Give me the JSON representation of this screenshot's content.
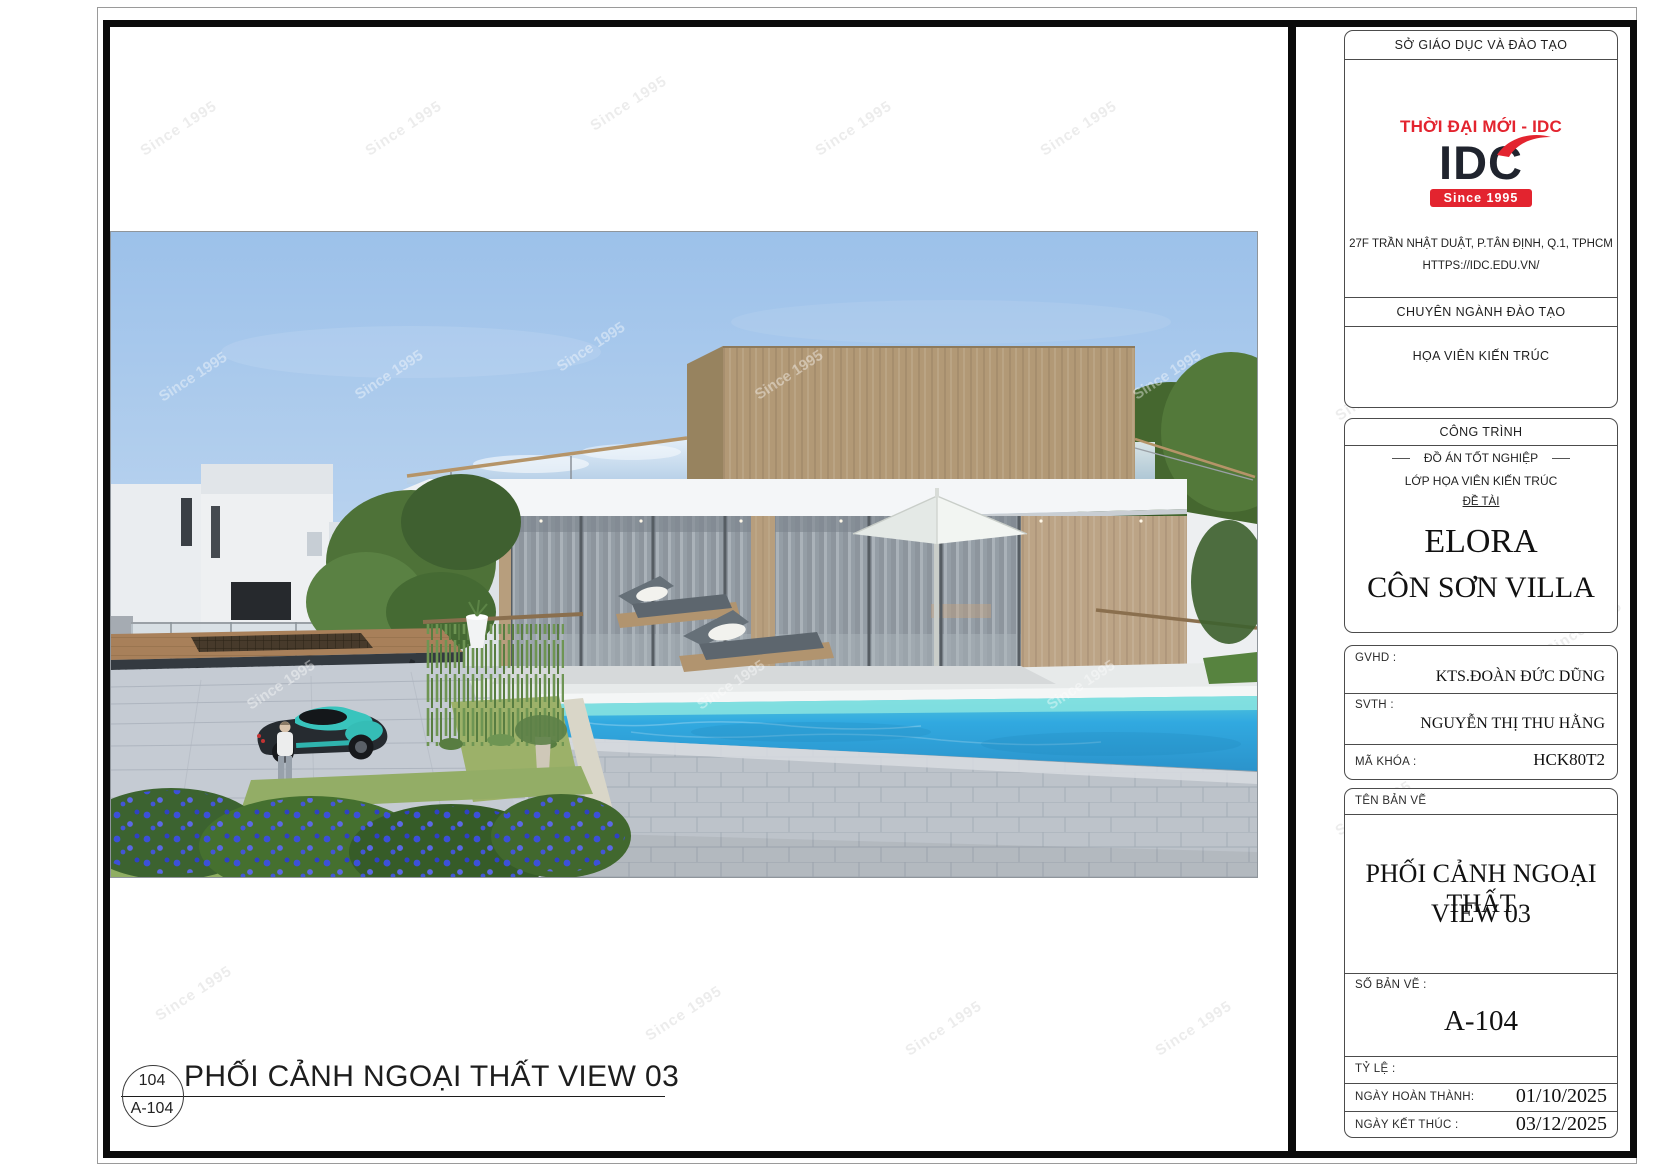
{
  "sheet": {
    "watermark": "Since 1995",
    "callout_number": "104",
    "callout_code": "A-104",
    "drawing_title": "PHỐI CẢNH NGOẠI THẤT VIEW 03"
  },
  "title_block": {
    "org_header": "SỞ GIÁO DỤC VÀ ĐÀO TẠO",
    "brand_tagline": "THỜI ĐẠI MỚI - IDC",
    "brand_logo": "IDC",
    "brand_since": "Since 1995",
    "address_line1": "27F TRẦN NHẬT DUẬT, P.TÂN ĐỊNH, Q.1, TPHCM",
    "address_line2": "HTTPS://IDC.EDU.VN/",
    "training_header": "CHUYÊN NGÀNH ĐÀO TẠO",
    "training_value": "HỌA VIÊN KIẾN TRÚC",
    "project_header": "CÔNG TRÌNH",
    "project_type": "ĐỒ ÁN TỐT NGHIỆP",
    "project_class": "LỚP HỌA VIÊN KIẾN TRÚC",
    "project_topic_label": "ĐỀ TÀI",
    "project_name_line1": "ELORA",
    "project_name_line2": "CÔN SƠN VILLA",
    "gvhd_label": "GVHD :",
    "gvhd_value": "KTS.ĐOÀN ĐỨC DŨNG",
    "svth_label": "SVTH :",
    "svth_value": "NGUYỄN THỊ THU HẰNG",
    "makhoa_label": "MÃ KHÓA :",
    "makhoa_value": "HCK80T2",
    "tenbanve_label": "TÊN BẢN VẼ",
    "tenbanve_line1": "PHỐI CẢNH NGOẠI THẤT",
    "tenbanve_line2": "VIEW 03",
    "sobanve_label": "SỐ BẢN VẼ :",
    "sobanve_value": "A-104",
    "tyle_label": "TỶ LỆ :",
    "done_label": "NGÀY HOÀN THÀNH:",
    "done_value": "01/10/2025",
    "end_label": "NGÀY KẾT THÚC :",
    "end_value": "03/12/2025"
  },
  "colors": {
    "brand_red": "#e3242f",
    "logo_dark": "#20242e",
    "sky_blue": "#a3c6ec",
    "pool_water": "#2ea4dc",
    "wood_tan": "#b29976",
    "stone_gray": "#bdc3ca"
  }
}
